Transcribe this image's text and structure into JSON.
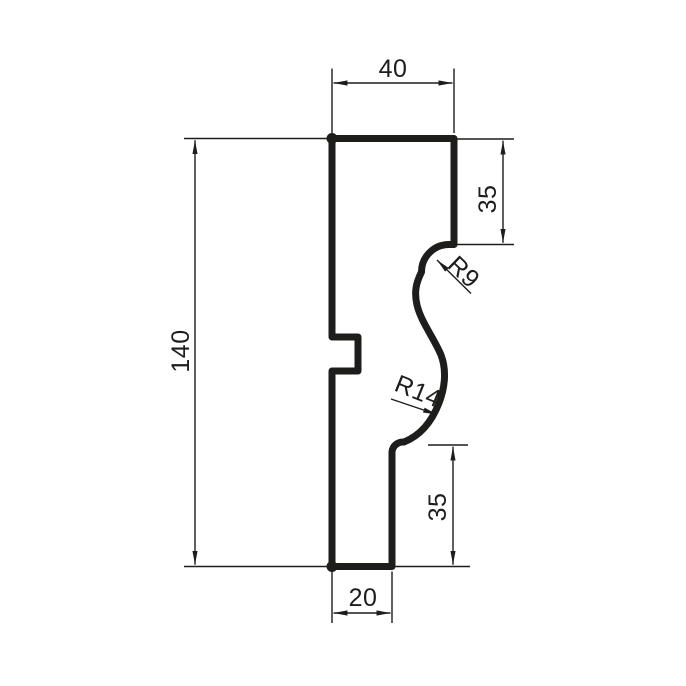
{
  "drawing": {
    "type": "technical-profile-drawing",
    "background_color": "#ffffff",
    "line_color": "#1d1d1b",
    "dimensions": {
      "top_width": "40",
      "upper_right_height": "35",
      "upper_fillet_radius": "R9",
      "lower_fillet_radius": "R14",
      "overall_height": "140",
      "lower_right_height": "35",
      "bottom_width": "20"
    }
  }
}
